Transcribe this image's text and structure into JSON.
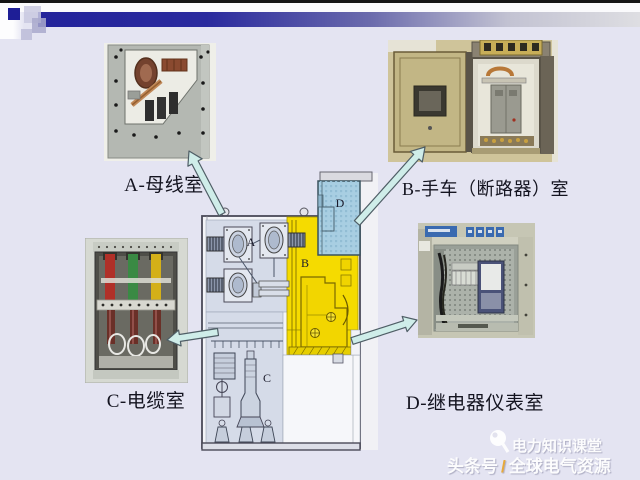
{
  "slide": {
    "background_color": "#E4E4F2",
    "top_edge_color": "#151515",
    "header_bar_start": "#23239B",
    "header_bar_end": "#DEDEE2",
    "accent_square_color": "#1E1E96"
  },
  "callouts": [
    {
      "id": "A",
      "label": "A-母线室",
      "diagram_letter": "A",
      "region_color": "#D5DBE8"
    },
    {
      "id": "B",
      "label": "B-手车（断路器）室",
      "diagram_letter": "B",
      "region_color": "#F5DB00"
    },
    {
      "id": "C",
      "label": "C-电缆室",
      "diagram_letter": "C",
      "region_color": "#D5DBE8"
    },
    {
      "id": "D",
      "label": "D-继电器仪表室",
      "diagram_letter": "D",
      "region_color": "#A8CEE2"
    }
  ],
  "arrow_style": {
    "fill": "#CFEDE9",
    "stroke": "#4F5E66"
  },
  "watermark": {
    "brand": "电力知识课堂",
    "channel": "头条号",
    "separator": "/",
    "source": "全球电气资源",
    "separator_color": "#E8A42C"
  }
}
